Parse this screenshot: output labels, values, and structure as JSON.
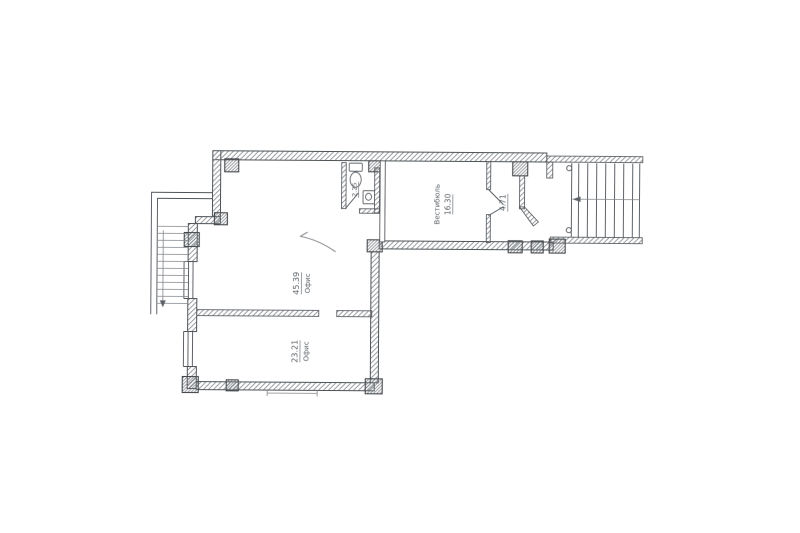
{
  "page": {
    "kind": "scanned architectural floor plan",
    "background": "#ffffff",
    "line_color": "#4e5257",
    "hatch_color": "#868a8f",
    "text_color": "#5d6368"
  },
  "floor_plan": {
    "rooms": [
      {
        "name": "Офис",
        "area": "45.39"
      },
      {
        "name": "Офис",
        "area": "23.21"
      },
      {
        "name": "Вестибюль",
        "area": "16.30"
      },
      {
        "name": "",
        "area": "4.71"
      },
      {
        "name": "",
        "area": "2.25"
      }
    ]
  }
}
